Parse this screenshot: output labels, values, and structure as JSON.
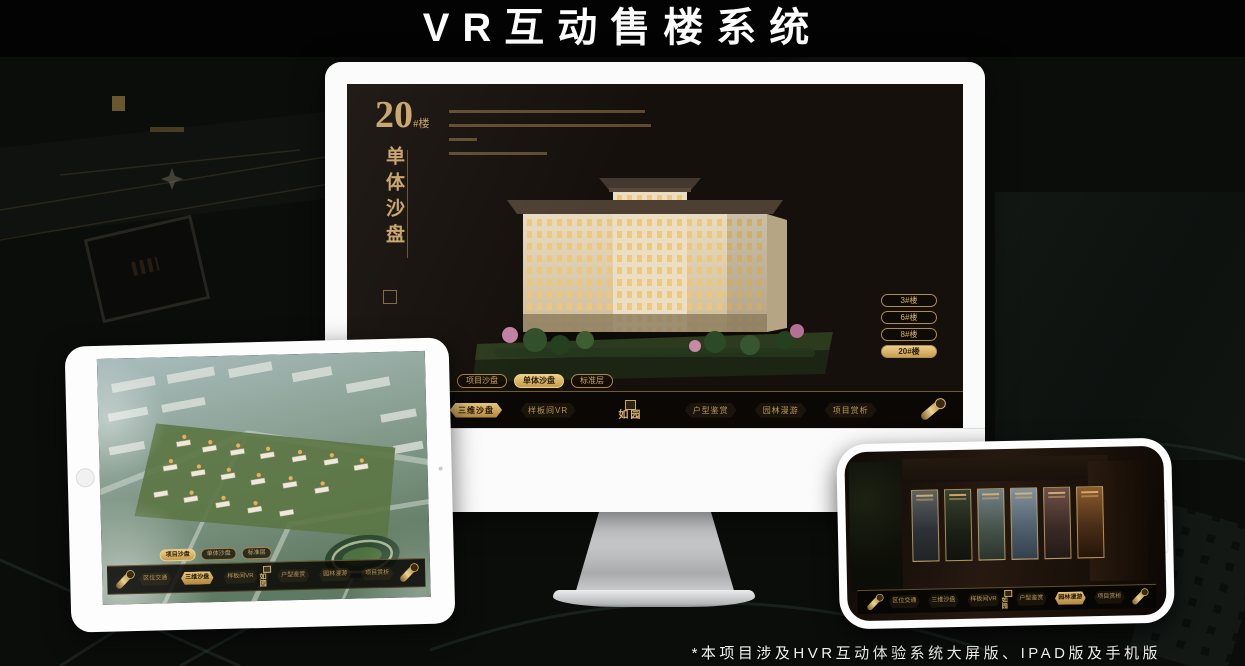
{
  "page": {
    "title": "VR互动售楼系统",
    "footer_note": "*本项目涉及HVR互动体验系统大屏版、IPAD版及手机版"
  },
  "logo": {
    "name": "如园"
  },
  "colors": {
    "gold_accent": "#cda55f",
    "gold_highlight": "#e0b96b",
    "screen_background": "#15100b"
  },
  "monitor_ui": {
    "building_number": "20",
    "building_unit": "#楼",
    "section_title": "单体沙盘",
    "floor_buttons": [
      {
        "label": "3#楼"
      },
      {
        "label": "6#楼"
      },
      {
        "label": "8#楼"
      },
      {
        "label": "20#楼",
        "active": true
      }
    ],
    "view_tabs": [
      {
        "label": "项目沙盘"
      },
      {
        "label": "单体沙盘",
        "active": true
      },
      {
        "label": "标准层"
      }
    ],
    "menu_left": [
      {
        "label": "区位交通"
      },
      {
        "label": "三维沙盘",
        "active": true
      },
      {
        "label": "样板间VR"
      }
    ],
    "menu_right": [
      {
        "label": "户型鉴赏"
      },
      {
        "label": "园林漫游"
      },
      {
        "label": "项目赏析"
      }
    ]
  },
  "tablet_ui": {
    "view_tabs": [
      {
        "label": "项目沙盘",
        "active": true
      },
      {
        "label": "单体沙盘"
      },
      {
        "label": "标准层"
      }
    ],
    "menu_left": [
      {
        "label": "区位交通"
      },
      {
        "label": "三维沙盘",
        "active": true
      },
      {
        "label": "样板间VR"
      }
    ],
    "menu_right": [
      {
        "label": "户型鉴赏"
      },
      {
        "label": "园林漫游"
      },
      {
        "label": "项目赏析"
      }
    ]
  },
  "phone_ui": {
    "menu_left": [
      {
        "label": "区位交通"
      },
      {
        "label": "三维沙盘"
      },
      {
        "label": "样板间VR"
      }
    ],
    "menu_right": [
      {
        "label": "户型鉴赏"
      },
      {
        "label": "园林漫游",
        "active": true
      },
      {
        "label": "项目赏析"
      }
    ]
  }
}
